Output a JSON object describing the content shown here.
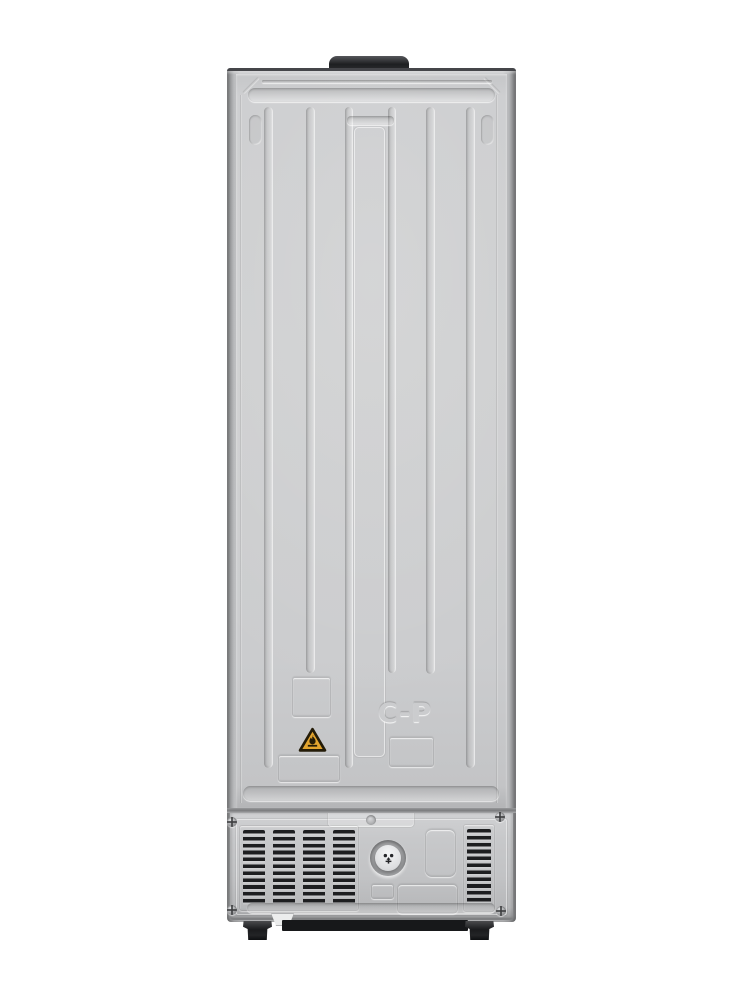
{
  "scene": {
    "description": "Rear view photograph of a freestanding refrigerator on a plain white background",
    "background_color": "#ffffff"
  },
  "appliance": {
    "marking": {
      "text": "C-P"
    },
    "warning_sticker": {
      "symbol": "flame",
      "meaning": "flammable refrigerant warning triangle",
      "fill_color": "#e2a42e",
      "border_color": "#241c08"
    },
    "drain_valve": {
      "symbol": "drain-plug"
    },
    "vents": {
      "left_columns": 4,
      "right_columns": 1,
      "rows": 11
    },
    "colors": {
      "panel": "#cbccce",
      "panel_shadow": "#b4b5b7",
      "side_edge": "#6e6f71",
      "top_cap": "#222325",
      "vent_slot": "#1d1e20",
      "foot": "#1a1b1d",
      "seam": "#7a7b7d",
      "sticker_amber": "#e2a42e"
    }
  }
}
